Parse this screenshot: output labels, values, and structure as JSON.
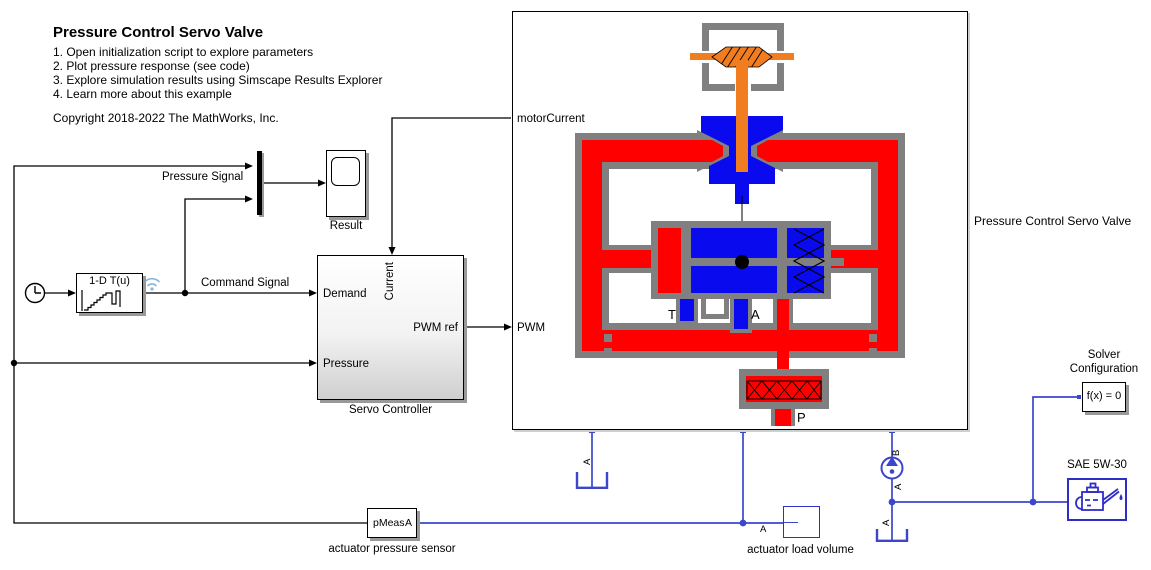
{
  "notes": {
    "title": "Pressure Control Servo Valve",
    "step1": "1. Open initialization script to explore parameters",
    "step2": "2. Plot pressure response (see code)",
    "step3": "3. Explore simulation results using Simscape Results Explorer",
    "step4": "4. Learn more about this example",
    "copyright": "Copyright 2018-2022 The MathWorks, Inc."
  },
  "signals": {
    "pressure": "Pressure Signal",
    "command": "Command Signal"
  },
  "lookup": {
    "label": "1-D T(u)"
  },
  "scope": {
    "name": "Result"
  },
  "servo": {
    "name": "Servo Controller",
    "port_demand": "Demand",
    "port_current": "Current",
    "port_pressure": "Pressure",
    "port_pwm_ref": "PWM ref"
  },
  "valve": {
    "name": "Pressure Control Servo Valve",
    "label_motor_current": "motorCurrent",
    "label_pwm": "PWM",
    "spool_t": "T",
    "spool_a": "A",
    "spool_p": "P",
    "port_t": "T",
    "port_a": "A",
    "port_p": "P"
  },
  "check_valve": {
    "port_b": "B",
    "port_a": "A"
  },
  "tanks": {
    "left_a": "A",
    "right_a": "A"
  },
  "solver": {
    "line1": "Solver",
    "line2": "Configuration",
    "label": "f(x) = 0"
  },
  "oil": {
    "name": "SAE 5W-30"
  },
  "sensor": {
    "label": "pMeas",
    "port": "A",
    "name": "actuator pressure sensor"
  },
  "load_volume": {
    "name": "actuator load volume",
    "port": "A"
  },
  "colors": {
    "red": "#ff0000",
    "blue": "#0a0aef",
    "gray": "#808080",
    "orange": "#f07d1f",
    "physical_line": "#3b46cb",
    "block_blue": "#2d2dc9"
  }
}
